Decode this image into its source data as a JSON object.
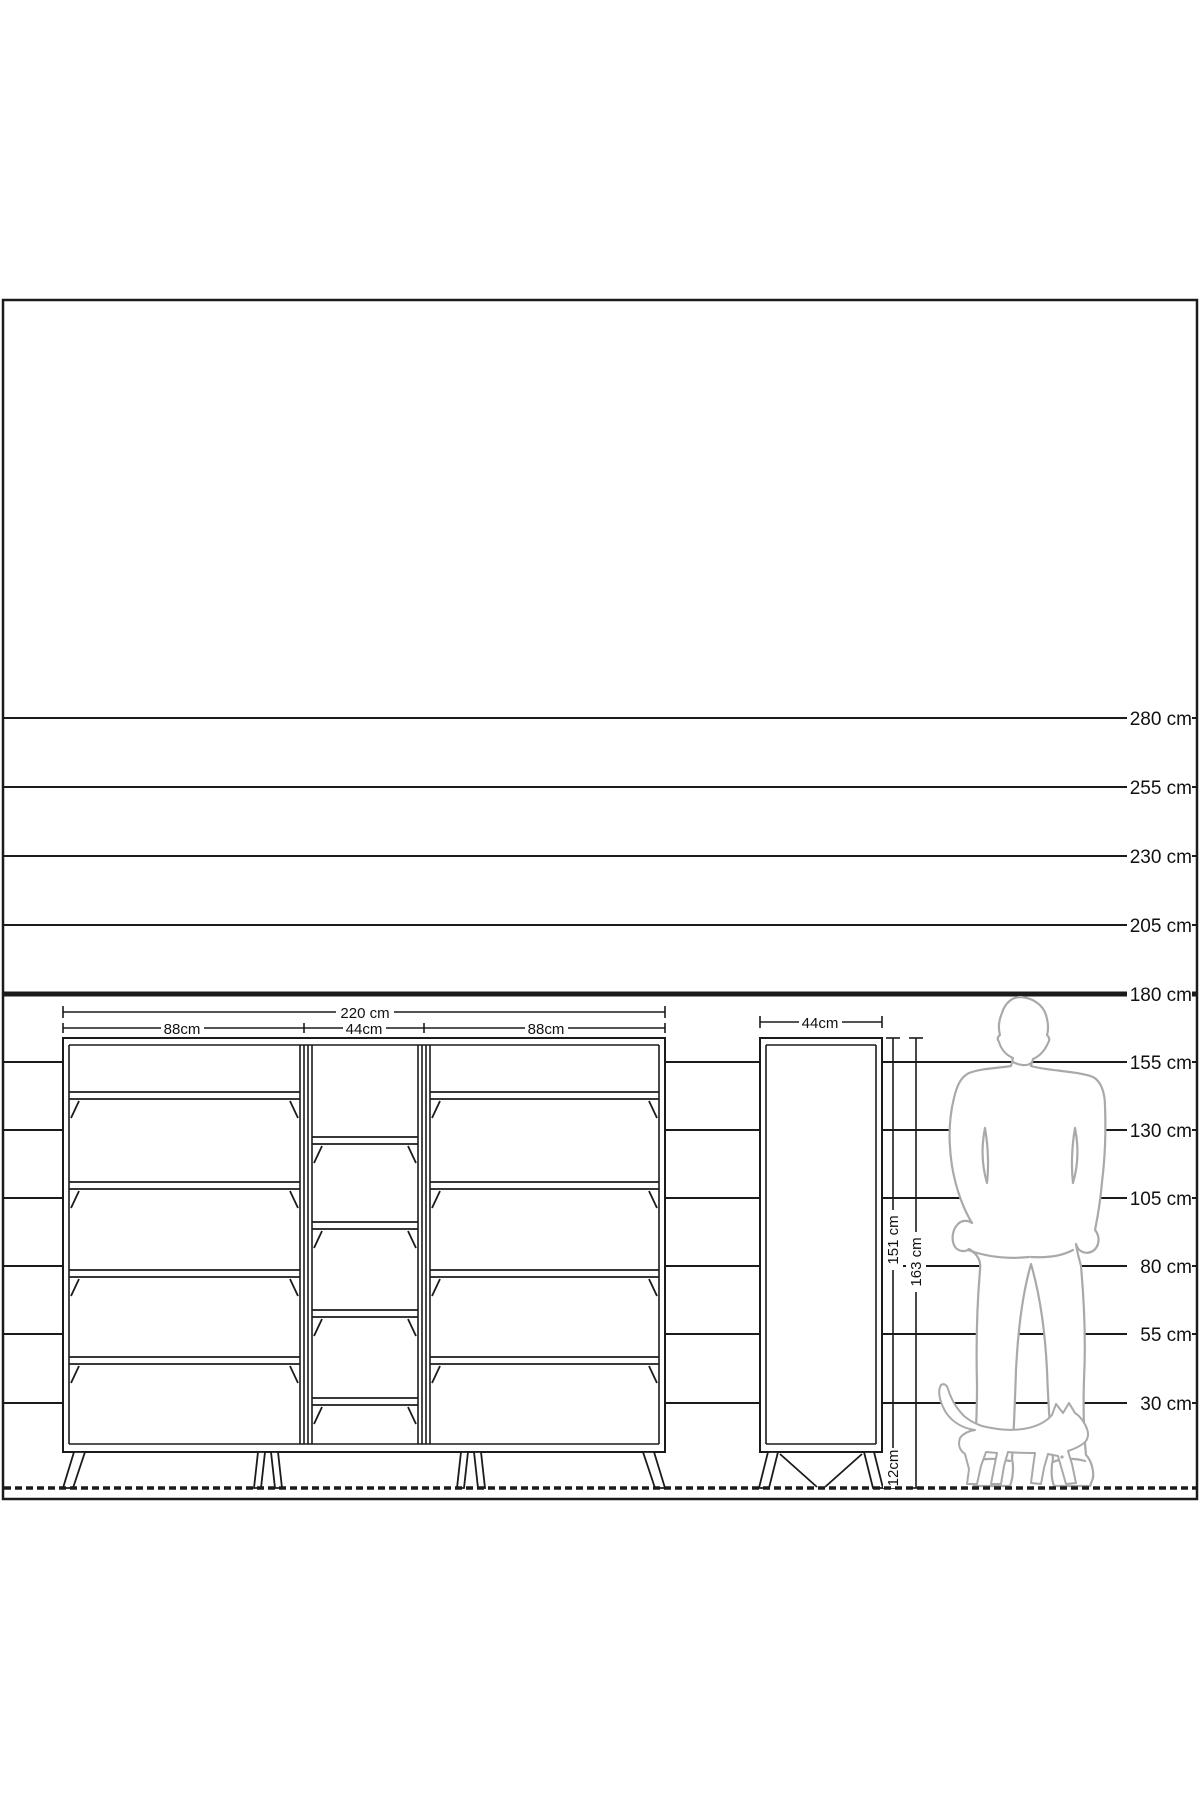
{
  "scale": {
    "unit": "cm",
    "values": [
      280,
      255,
      230,
      205,
      180,
      155,
      130,
      105,
      80,
      55,
      30
    ],
    "labels": [
      "280 cm",
      "255 cm",
      "230 cm",
      "205 cm",
      "180 cm",
      "155 cm",
      "130 cm",
      "105 cm",
      "80 cm",
      "55 cm",
      "30 cm"
    ],
    "emphasized_value": 180
  },
  "front_cabinet": {
    "total_width_label": "220 cm",
    "section_width_labels": [
      "88cm",
      "44cm",
      "88cm"
    ]
  },
  "side_cabinet": {
    "width_label": "44cm",
    "body_height_label": "151 cm",
    "total_height_label": "163 cm",
    "leg_height_label": "12cm"
  },
  "figures": {
    "man_icon": "standing-man-back-silhouette",
    "cat_icon": "walking-cat-silhouette"
  },
  "colors": {
    "line": "#1b1b1b",
    "figure_outline": "#a9a9a9",
    "background": "#ffffff",
    "text": "#111111"
  }
}
